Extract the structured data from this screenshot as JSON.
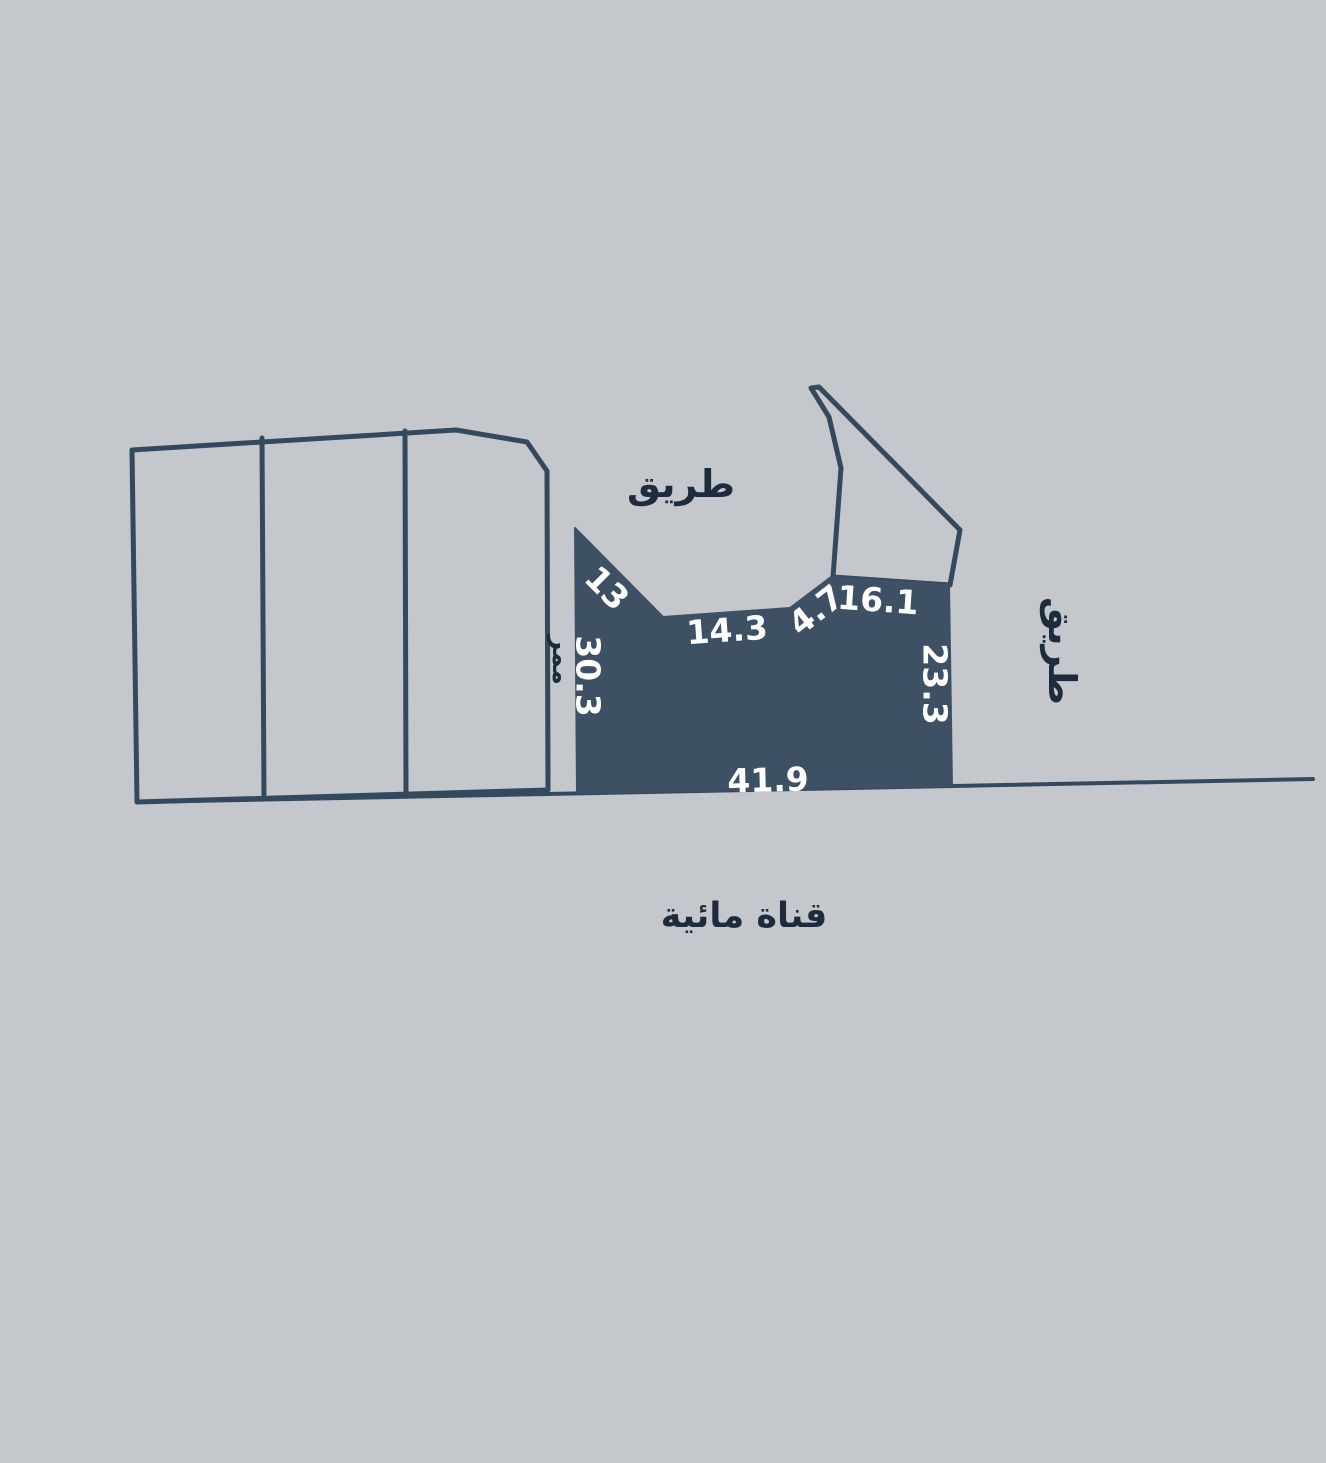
{
  "scene": {
    "type": "cadastral-plot-map",
    "colors": {
      "background": "#c4c8cc",
      "outline": "#35495e",
      "plot_fill": "#3e5063",
      "dark_text": "#1e2b3c",
      "light_text": "#ffffff"
    },
    "subject_plot": {
      "dimension_labels": {
        "northwest_diagonal": "13",
        "west_side": "30.3",
        "north_side_left": "14.3",
        "north_side_middle": "4.7",
        "north_side_right": "16.1",
        "east_side": "23.3",
        "south_side": "41.9"
      }
    },
    "area_labels": {
      "road_top": "طريق",
      "road_right": "طريق",
      "passage": "ممر",
      "water_canal": "قناة مائية"
    }
  }
}
